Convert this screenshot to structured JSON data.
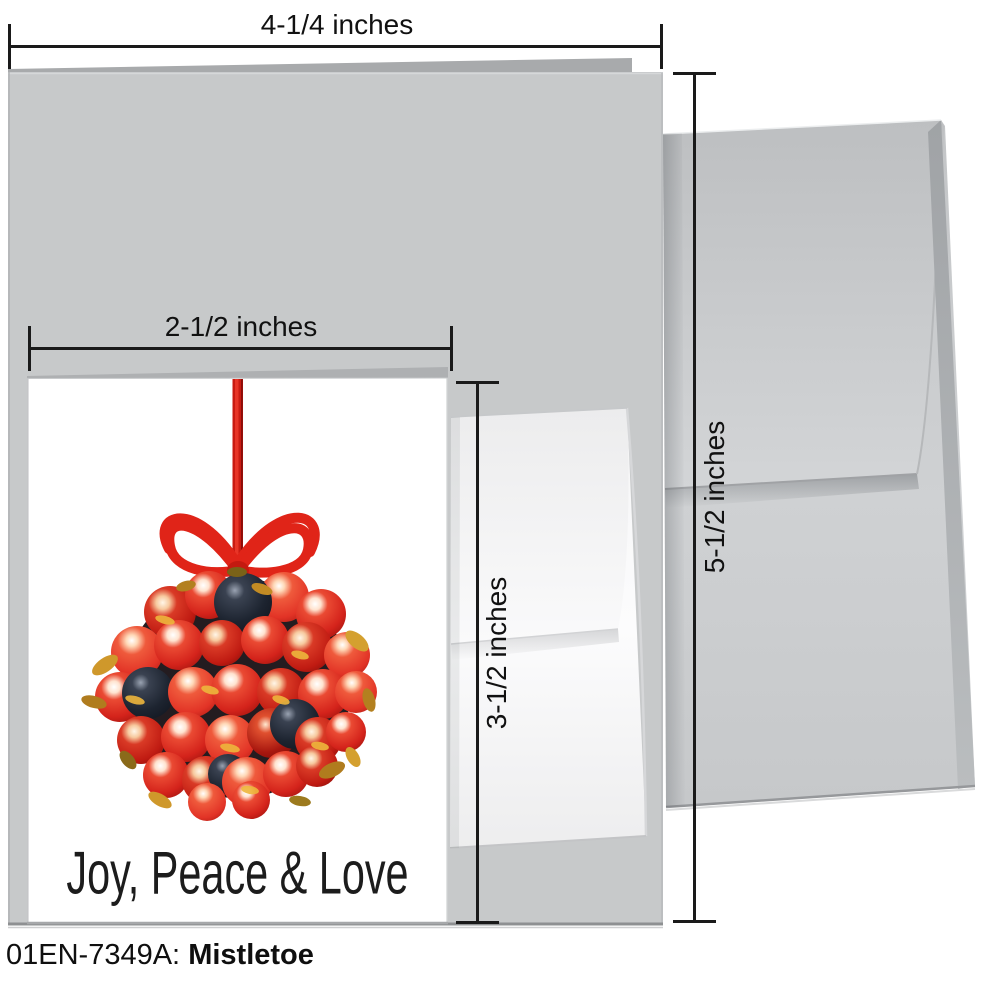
{
  "product": {
    "code_label": "01EN-7349A:",
    "name": "Mistletoe"
  },
  "card": {
    "greeting": "Joy, Peace & Love",
    "illustration": "mistletoe-berry-kissing-ball-hanging-from-red-ribbon-bow"
  },
  "dimensions": {
    "folded_card_width": "4-1/4 inches",
    "folded_card_height": "5-1/2 inches",
    "note_card_width": "2-1/2 inches",
    "note_card_height": "3-1/2 inches"
  },
  "colors": {
    "large_card_gray": "#c7c9ca",
    "large_envelope_gray": "#caccce",
    "small_envelope_white": "#f7f7f8",
    "berry_red": "#d4231b",
    "ribbon_red": "#e02418",
    "dark_berry_navy": "#1d2430",
    "leaf_gold": "#d29a2c",
    "dimension_line_black": "#1a1a1a"
  }
}
